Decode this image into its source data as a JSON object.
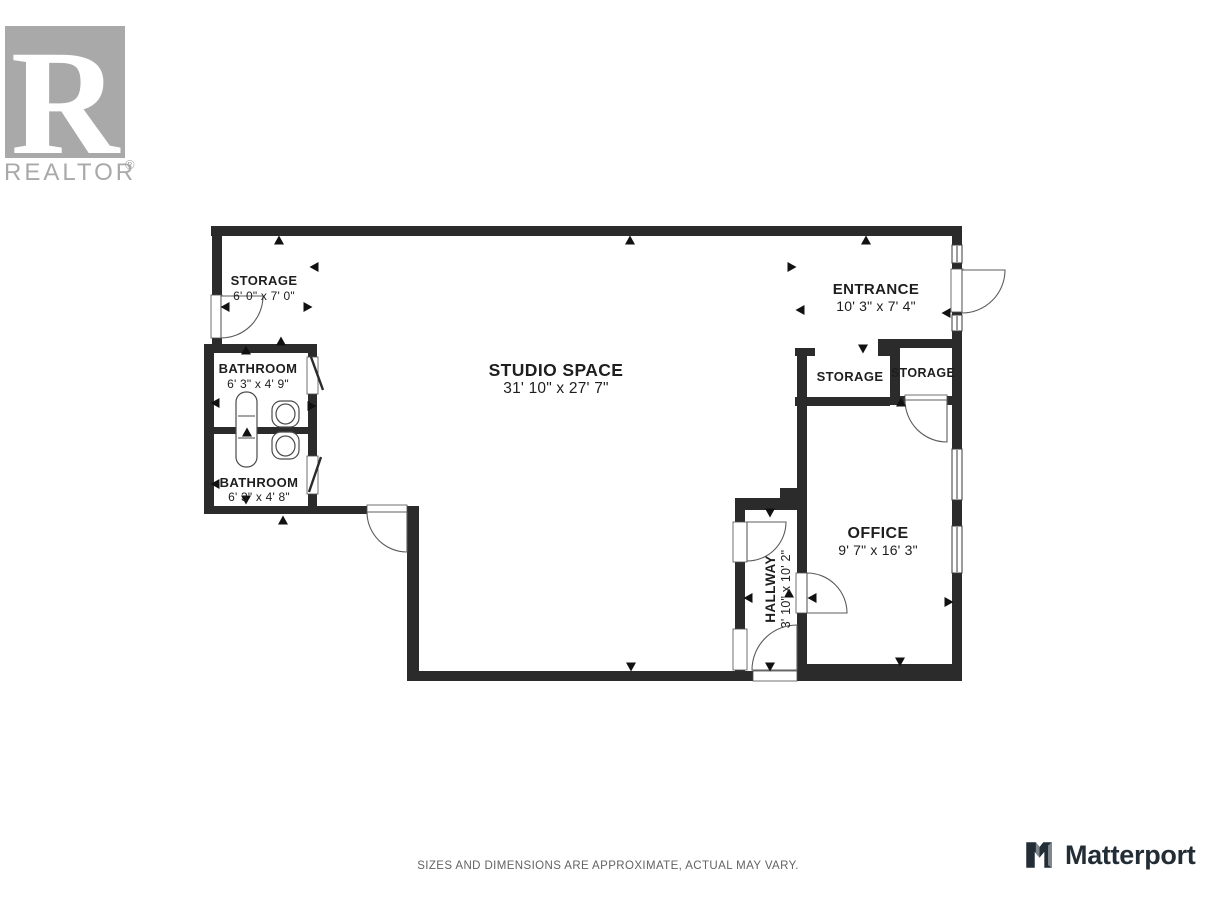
{
  "branding": {
    "realtor_monogram": "R",
    "realtor_wordmark": "REALTOR",
    "realtor_reg": "®",
    "matterport_text": "Matterport"
  },
  "disclaimer": "SIZES AND DIMENSIONS ARE APPROXIMATE, ACTUAL MAY VARY.",
  "colors": {
    "wall": "#2b2b2b",
    "door_stroke": "#5c5c5c",
    "jamb_stroke": "#4f4f4f",
    "window_stroke": "#3a3a3a",
    "fixture_stroke": "#4a4a4a",
    "arrow": "#111111",
    "label": "#1e1e1e",
    "realtor_gray": "#a9a9a9",
    "matterport_dark": "#232d36",
    "matterport_gray": "#7d868d"
  },
  "floorplan": {
    "rooms": [
      {
        "name": "STORAGE",
        "dims": "6' 0\" x 7' 0\"",
        "cx": 264,
        "cy": 292,
        "rotate": 0,
        "name_size": 13,
        "dims_size": 12,
        "name_dy": -7,
        "dims_dy": 8
      },
      {
        "name": "BATHROOM",
        "dims": "6' 3\" x 4' 9\"",
        "cx": 258,
        "cy": 380,
        "rotate": 0,
        "name_size": 13,
        "dims_size": 12,
        "name_dy": -7,
        "dims_dy": 8
      },
      {
        "name": "BATHROOM",
        "dims": "6' 3\" x 4' 8\"",
        "cx": 259,
        "cy": 493,
        "rotate": 0,
        "name_size": 13,
        "dims_size": 12,
        "name_dy": -6,
        "dims_dy": 8
      },
      {
        "name": "STUDIO SPACE",
        "dims": "31' 10\" x 27' 7\"",
        "cx": 556,
        "cy": 384,
        "rotate": 0,
        "name_size": 17.5,
        "dims_size": 15.5,
        "name_dy": -8,
        "dims_dy": 9
      },
      {
        "name": "ENTRANCE",
        "dims": "10' 3\" x 7' 4\"",
        "cx": 876,
        "cy": 302,
        "rotate": 0,
        "name_size": 15,
        "dims_size": 14,
        "name_dy": -8,
        "dims_dy": 9
      },
      {
        "name": "STORAGE",
        "dims": null,
        "cx": 850,
        "cy": 381,
        "rotate": 0,
        "name_size": 13,
        "dims_size": 12,
        "name_dy": 0,
        "dims_dy": 0
      },
      {
        "name": "STORAGE",
        "dims": null,
        "cx": 923,
        "cy": 377,
        "rotate": 0,
        "name_size": 12.5,
        "dims_size": 12,
        "name_dy": 0,
        "dims_dy": 0
      },
      {
        "name": "OFFICE",
        "dims": "9' 7\" x 16' 3\"",
        "cx": 878,
        "cy": 546,
        "rotate": 0,
        "name_size": 16,
        "dims_size": 14,
        "name_dy": -8,
        "dims_dy": 9
      },
      {
        "name": "HALLWAY",
        "dims": "3' 10\" x 10' 2\"",
        "cx": 779,
        "cy": 589,
        "rotate": -90,
        "name_size": 13.5,
        "dims_size": 12.5,
        "name_dy": -4,
        "dims_dy": 11
      }
    ],
    "walls": [
      [
        211,
        226,
        751,
        10
      ],
      [
        212,
        226,
        10,
        69
      ],
      [
        212,
        338,
        10,
        8
      ],
      [
        204,
        344,
        10,
        170
      ],
      [
        204,
        344,
        113,
        9
      ],
      [
        213,
        427,
        95,
        7
      ],
      [
        204,
        506,
        163,
        8
      ],
      [
        308,
        344,
        9,
        13
      ],
      [
        308,
        394,
        9,
        62
      ],
      [
        308,
        494,
        9,
        20
      ],
      [
        407,
        506,
        12,
        175
      ],
      [
        407,
        671,
        338,
        10
      ],
      [
        735,
        498,
        10,
        25
      ],
      [
        735,
        562,
        10,
        67
      ],
      [
        735,
        670,
        10,
        11
      ],
      [
        735,
        498,
        62,
        12
      ],
      [
        780,
        488,
        27,
        11
      ],
      [
        797,
        348,
        10,
        225
      ],
      [
        797,
        613,
        10,
        68
      ],
      [
        795,
        348,
        20,
        8
      ],
      [
        878,
        339,
        12,
        17
      ],
      [
        890,
        339,
        10,
        66
      ],
      [
        890,
        339,
        62,
        9
      ],
      [
        890,
        396,
        15,
        9
      ],
      [
        947,
        396,
        15,
        9
      ],
      [
        795,
        397,
        95,
        9
      ],
      [
        952,
        236,
        10,
        9
      ],
      [
        952,
        263,
        10,
        6
      ],
      [
        952,
        312,
        10,
        3
      ],
      [
        952,
        331,
        10,
        118
      ],
      [
        952,
        500,
        10,
        26
      ],
      [
        952,
        573,
        10,
        108
      ],
      [
        800,
        664,
        162,
        17
      ],
      [
        745,
        671,
        8,
        10
      ]
    ],
    "jambs": [
      [
        211,
        295,
        11,
        43
      ],
      [
        951,
        269,
        12,
        43
      ],
      [
        307,
        357,
        11,
        37
      ],
      [
        307,
        456,
        11,
        38
      ],
      [
        367,
        505,
        40,
        10
      ],
      [
        905,
        395,
        42,
        10
      ],
      [
        733,
        522,
        14,
        40
      ],
      [
        733,
        629,
        14,
        41
      ],
      [
        796,
        573,
        12,
        40
      ],
      [
        753,
        671,
        44,
        10
      ]
    ],
    "windows": [
      [
        952,
        245,
        10,
        18
      ],
      [
        952,
        315,
        10,
        16
      ],
      [
        952,
        449,
        10,
        51
      ],
      [
        952,
        526,
        10,
        47
      ]
    ],
    "doors": [
      "M221,296 L263,296 A42,42 0 0 1 221,338 Z",
      "M407,512 L367,512 A40,40 0 0 0 407,552 Z",
      "M747,522 L786,522 A39,39 0 0 1 747,561 Z",
      "M807,613 L847,613 A40,40 0 0 0 807,573 Z",
      "M797,670 L752,670 A45,45 0 0 1 797,625 Z",
      "M947,400 L905,400 A42,42 0 0 0 947,442 Z",
      "M962,270 L1005,270 A43,43 0 0 1 962,313 Z"
    ],
    "door_leaves": [
      [
        311,
        357,
        323,
        390
      ],
      [
        321,
        457,
        309,
        492
      ]
    ],
    "fixtures": [
      {
        "t": "rrect",
        "x": 236,
        "y": 392,
        "w": 21,
        "h": 75,
        "r": 10,
        "n": "bathtub"
      },
      {
        "t": "line",
        "x1": 238,
        "y1": 416,
        "x2": 255,
        "y2": 416,
        "n": "bathtub-divider"
      },
      {
        "t": "line",
        "x1": 238,
        "y1": 438,
        "x2": 255,
        "y2": 438,
        "n": "bathtub-divider"
      },
      {
        "t": "rrect",
        "x": 272,
        "y": 401,
        "w": 27,
        "h": 26,
        "r": 9,
        "n": "toilet"
      },
      {
        "t": "ellipse",
        "cx": 285.5,
        "cy": 414,
        "rx": 9.5,
        "ry": 10,
        "n": "toilet-bowl"
      },
      {
        "t": "rrect",
        "x": 272,
        "y": 432,
        "w": 27,
        "h": 27,
        "r": 9,
        "n": "toilet"
      },
      {
        "t": "ellipse",
        "cx": 285.5,
        "cy": 446,
        "rx": 9.5,
        "ry": 10,
        "n": "toilet-bowl"
      }
    ],
    "arrows": [
      {
        "x": 279,
        "y": 240,
        "d": "u"
      },
      {
        "x": 630,
        "y": 240,
        "d": "u"
      },
      {
        "x": 866,
        "y": 240,
        "d": "u"
      },
      {
        "x": 314,
        "y": 267,
        "d": "l"
      },
      {
        "x": 225,
        "y": 307,
        "d": "l"
      },
      {
        "x": 308,
        "y": 307,
        "d": "r"
      },
      {
        "x": 281,
        "y": 341,
        "d": "u"
      },
      {
        "x": 246,
        "y": 350,
        "d": "u"
      },
      {
        "x": 215,
        "y": 403,
        "d": "l"
      },
      {
        "x": 312,
        "y": 406,
        "d": "r"
      },
      {
        "x": 247,
        "y": 432,
        "d": "u"
      },
      {
        "x": 215,
        "y": 484,
        "d": "l"
      },
      {
        "x": 246,
        "y": 500,
        "d": "d"
      },
      {
        "x": 283,
        "y": 520,
        "d": "u"
      },
      {
        "x": 631,
        "y": 667,
        "d": "d"
      },
      {
        "x": 792,
        "y": 267,
        "d": "r"
      },
      {
        "x": 800,
        "y": 310,
        "d": "l"
      },
      {
        "x": 946,
        "y": 313,
        "d": "l"
      },
      {
        "x": 863,
        "y": 349,
        "d": "d"
      },
      {
        "x": 901,
        "y": 402,
        "d": "u"
      },
      {
        "x": 900,
        "y": 662,
        "d": "d"
      },
      {
        "x": 949,
        "y": 602,
        "d": "r"
      },
      {
        "x": 812,
        "y": 598,
        "d": "l"
      },
      {
        "x": 770,
        "y": 513,
        "d": "d"
      },
      {
        "x": 770,
        "y": 667,
        "d": "d"
      },
      {
        "x": 748,
        "y": 598,
        "d": "l"
      },
      {
        "x": 789,
        "y": 593,
        "d": "u"
      }
    ]
  }
}
